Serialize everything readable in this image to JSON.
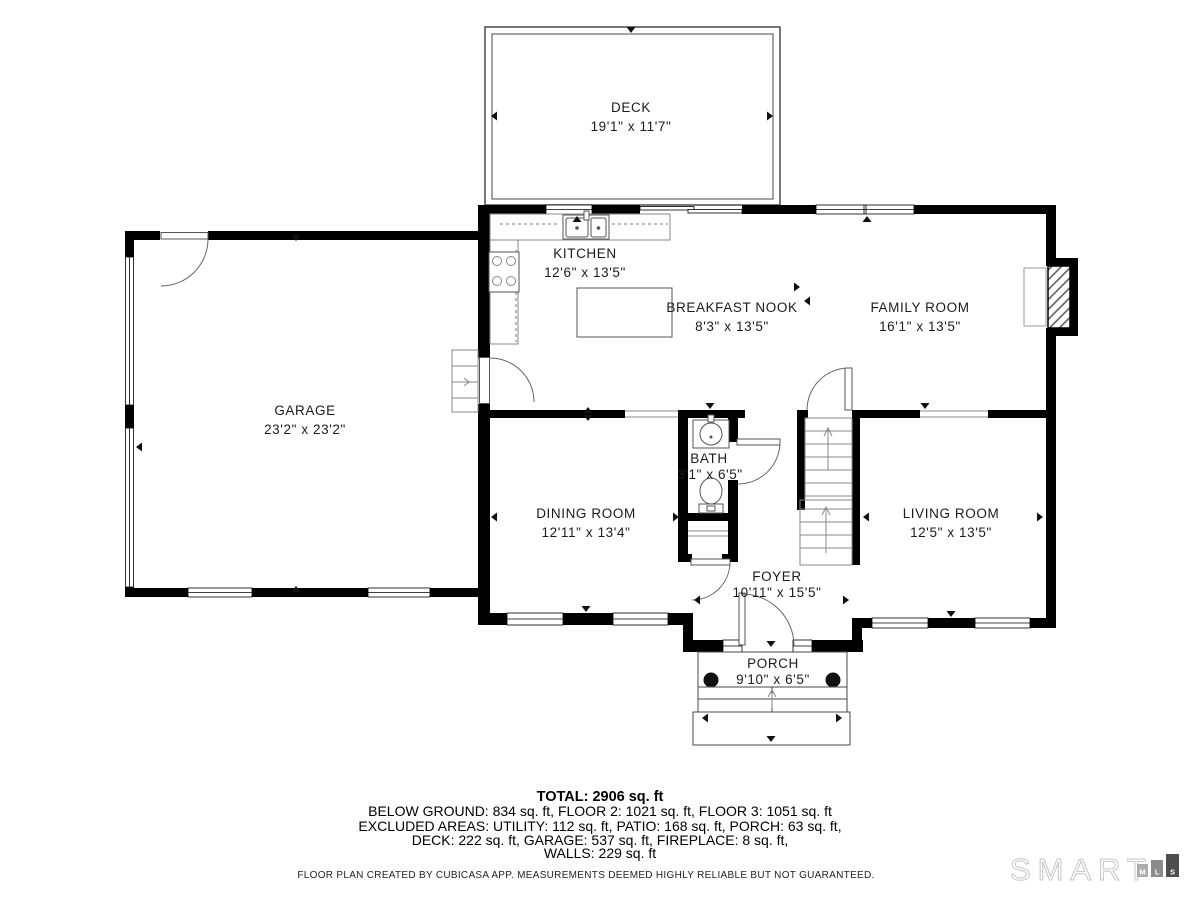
{
  "rooms": {
    "deck": {
      "name": "DECK",
      "dims": "19'1\" x 11'7\""
    },
    "kitchen": {
      "name": "KITCHEN",
      "dims": "12'6\" x 13'5\""
    },
    "breakfast_nook": {
      "name": "BREAKFAST NOOK",
      "dims": "8'3\" x 13'5\""
    },
    "family_room": {
      "name": "FAMILY ROOM",
      "dims": "16'1\" x 13'5\""
    },
    "garage": {
      "name": "GARAGE",
      "dims": "23'2\" x 23'2\""
    },
    "bath": {
      "name": "BATH",
      "dims": "3'1\" x 6'5\""
    },
    "dining_room": {
      "name": "DINING ROOM",
      "dims": "12'11\" x 13'4\""
    },
    "living_room": {
      "name": "LIVING ROOM",
      "dims": "12'5\" x 13'5\""
    },
    "foyer": {
      "name": "FOYER",
      "dims": "10'11\" x 15'5\""
    },
    "porch": {
      "name": "PORCH",
      "dims": "9'10\" x 6'5\""
    }
  },
  "summary": {
    "total": "TOTAL: 2906 sq. ft",
    "floors": "BELOW GROUND: 834 sq. ft, FLOOR 2: 1021 sq. ft, FLOOR 3: 1051 sq. ft",
    "excluded1": "EXCLUDED AREAS: UTILITY: 112 sq. ft, PATIO: 168 sq. ft, PORCH: 63 sq. ft,",
    "excluded2": "DECK: 222 sq. ft, GARAGE: 537 sq. ft, FIREPLACE: 8 sq. ft,",
    "excluded3": "WALLS: 229 sq. ft"
  },
  "disclaimer": "FLOOR PLAN CREATED BY CUBICASA APP. MEASUREMENTS DEEMED HIGHLY RELIABLE BUT NOT GUARANTEED.",
  "logo": {
    "brand": "SMART",
    "blocks": [
      "M",
      "L",
      "S"
    ]
  },
  "colors": {
    "wall": "#000000",
    "thin_line": "#4a4a4a",
    "logo_outline": "#c6c6c6",
    "logo_block_m": "#adadad",
    "logo_block_l": "#8c8c8c",
    "logo_block_s": "#4e4e4e"
  }
}
